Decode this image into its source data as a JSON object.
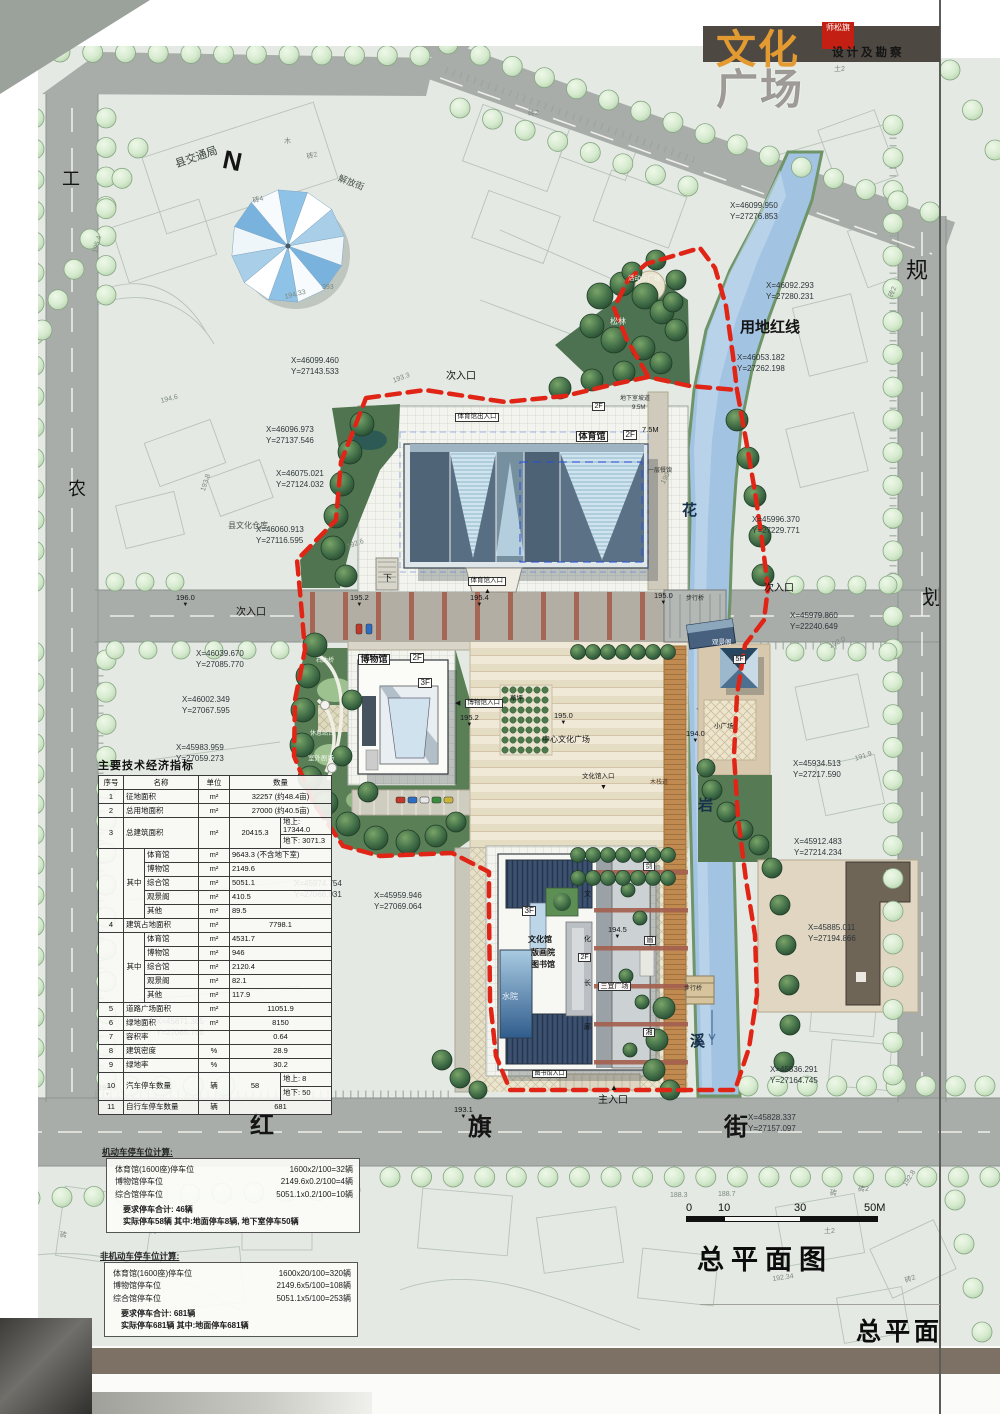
{
  "page": {
    "brand_top": "文化",
    "brand_bottom": "广场",
    "seal": "师松旗",
    "subtitle": "设计及勘察",
    "plan_title": "总平面图",
    "corner_label": "总平面"
  },
  "scalebar": {
    "labels": [
      "0",
      "10",
      "30",
      "50M"
    ]
  },
  "indicators": {
    "title": "主要技术经济指标",
    "headers": [
      "序号",
      "名称",
      "单位",
      "数量"
    ],
    "rows": [
      {
        "no": "1",
        "name": "征地面积",
        "unit": "m²",
        "qty": "32257 (约48.4亩)"
      },
      {
        "no": "2",
        "name": "总用地面积",
        "unit": "m²",
        "qty": "27000 (约40.5亩)"
      },
      {
        "no": "3",
        "name": "总建筑面积",
        "unit": "m²",
        "qty": "20415.3",
        "split": [
          "地上: 17344.0",
          "地下: 3071.3"
        ]
      },
      {
        "group": "其中",
        "items": [
          {
            "name": "体育馆",
            "unit": "m²",
            "qty": "9643.3 (不含地下室)"
          },
          {
            "name": "博物馆",
            "unit": "m²",
            "qty": "2149.6"
          },
          {
            "name": "综合馆",
            "unit": "m²",
            "qty": "5051.1"
          },
          {
            "name": "观景阁",
            "unit": "m²",
            "qty": "410.5"
          },
          {
            "name": "其他",
            "unit": "m²",
            "qty": "89.5"
          }
        ]
      },
      {
        "no": "4",
        "name": "建筑占地面积",
        "unit": "m²",
        "qty": "7798.1"
      },
      {
        "group": "其中",
        "items": [
          {
            "name": "体育馆",
            "unit": "m²",
            "qty": "4531.7"
          },
          {
            "name": "博物馆",
            "unit": "m²",
            "qty": "946"
          },
          {
            "name": "综合馆",
            "unit": "m²",
            "qty": "2120.4"
          },
          {
            "name": "观景阁",
            "unit": "m²",
            "qty": "82.1"
          },
          {
            "name": "其他",
            "unit": "m²",
            "qty": "117.9"
          }
        ]
      },
      {
        "no": "5",
        "name": "道路广场面积",
        "unit": "m²",
        "qty": "11051.9"
      },
      {
        "no": "6",
        "name": "绿地面积",
        "unit": "m²",
        "qty": "8150"
      },
      {
        "no": "7",
        "name": "容积率",
        "unit": "",
        "qty": "0.64"
      },
      {
        "no": "8",
        "name": "建筑密度",
        "unit": "%",
        "qty": "28.9"
      },
      {
        "no": "9",
        "name": "绿地率",
        "unit": "%",
        "qty": "30.2"
      },
      {
        "no": "10",
        "name": "汽车停车数量",
        "unit": "辆",
        "qty": "58",
        "split": [
          "地上:  8",
          "地下:  50"
        ]
      },
      {
        "no": "11",
        "name": "自行车停车数量",
        "unit": "辆",
        "qty": "681"
      }
    ]
  },
  "parking": {
    "motor": {
      "heading": "机动车停车位计算:",
      "rows": [
        [
          "体育馆(1600座)停车位",
          "1600x2/100=32辆"
        ],
        [
          "博物馆停车位",
          "2149.6x0.2/100=4辆"
        ],
        [
          "综合馆停车位",
          "5051.1x0.2/100=10辆"
        ]
      ],
      "required": "要求停车合计: 46辆",
      "actual": "实际停车58辆  其中:地面停车8辆, 地下室停车50辆"
    },
    "nonmotor": {
      "heading": "非机动车停车位计算:",
      "rows": [
        [
          "体育馆(1600座)停车位",
          "1600x20/100=320辆"
        ],
        [
          "博物馆停车位",
          "2149.6x5/100=108辆"
        ],
        [
          "综合馆停车位",
          "5051.1x5/100=253辆"
        ]
      ],
      "required": "要求停车合计: 681辆",
      "actual": "实际停车681辆  其中:地面停车681辆"
    }
  },
  "map": {
    "colors": {
      "boundary_red": "#e02517",
      "river_blue": "#a2c4e2",
      "road_gray": "#a8adaa",
      "roof_slate": "#506478",
      "roof_light": "#cbe0ea",
      "tree_light": "#d7ebd2",
      "tree_dark": "#30593a",
      "brand_orange": "#e29a31",
      "titlebar_dark": "#4e4843",
      "bottom_band": "#7c7164"
    },
    "labels": [
      {
        "t": "工",
        "x": 62,
        "y": 170,
        "s": 18
      },
      {
        "t": "农",
        "x": 68,
        "y": 480,
        "s": 18
      },
      {
        "t": "规",
        "x": 906,
        "y": 260,
        "s": 22
      },
      {
        "t": "划",
        "x": 922,
        "y": 588,
        "s": 20
      },
      {
        "t": "N",
        "x": 226,
        "y": 146,
        "s": 26,
        "w": 700,
        "r": 12
      },
      {
        "t": "县交通局",
        "x": 174,
        "y": 160,
        "s": 11,
        "r": -19,
        "c": "#39433d"
      },
      {
        "t": "解放街",
        "x": 340,
        "y": 174,
        "s": 9,
        "r": 21,
        "c": "#4a544e"
      },
      {
        "t": "县文化仓库",
        "x": 228,
        "y": 522,
        "s": 8,
        "c": "#4a544e"
      },
      {
        "t": "用地红线",
        "x": 740,
        "y": 320,
        "s": 15,
        "w": 700
      },
      {
        "t": "次入口",
        "x": 446,
        "y": 372,
        "s": 10
      },
      {
        "t": "次入口",
        "x": 236,
        "y": 608,
        "s": 10
      },
      {
        "t": "次入口",
        "x": 764,
        "y": 584,
        "s": 10
      },
      {
        "t": "主入口",
        "x": 598,
        "y": 1096,
        "s": 10
      },
      {
        "t": "红",
        "x": 250,
        "y": 1114,
        "s": 24,
        "w": 700
      },
      {
        "t": "旗",
        "x": 468,
        "y": 1116,
        "s": 24,
        "w": 700
      },
      {
        "t": "街",
        "x": 724,
        "y": 1116,
        "s": 24,
        "w": 700
      },
      {
        "t": "花",
        "x": 682,
        "y": 503,
        "s": 15,
        "w": 700,
        "c": "#17304c"
      },
      {
        "t": "岩",
        "x": 698,
        "y": 798,
        "s": 15,
        "w": 700,
        "c": "#17304c"
      },
      {
        "t": "溪",
        "x": 690,
        "y": 1034,
        "s": 15,
        "w": 700,
        "c": "#17304c"
      },
      {
        "t": "体育馆",
        "x": 576,
        "y": 431,
        "s": 9,
        "w": 700,
        "bg": 1
      },
      {
        "t": "2F",
        "x": 623,
        "y": 430,
        "s": 8,
        "bg": 1
      },
      {
        "t": "体育馆出入口",
        "x": 455,
        "y": 413,
        "s": 6.5,
        "bg": 1
      },
      {
        "t": "体育馆入口",
        "x": 468,
        "y": 577,
        "s": 6.5,
        "bg": 1
      },
      {
        "t": "下",
        "x": 383,
        "y": 574,
        "s": 9
      },
      {
        "t": "7.5M",
        "x": 642,
        "y": 426,
        "s": 7.5
      },
      {
        "t": "一层餐饮",
        "x": 648,
        "y": 468,
        "s": 6,
        "c": "#333333"
      },
      {
        "t": "地下室坡道",
        "x": 620,
        "y": 396,
        "s": 6,
        "c": "#333333"
      },
      {
        "t": "9.5M",
        "x": 632,
        "y": 405,
        "s": 6,
        "c": "#333333"
      },
      {
        "t": "2F",
        "x": 592,
        "y": 402,
        "s": 7,
        "bg": 1
      },
      {
        "t": "活动小广场",
        "x": 628,
        "y": 276,
        "s": 6.5,
        "c": "#f2f6f0"
      },
      {
        "t": "松林",
        "x": 610,
        "y": 318,
        "s": 8,
        "c": "#e9f1e5"
      },
      {
        "t": "博物馆",
        "x": 358,
        "y": 654,
        "s": 9,
        "w": 700,
        "bg": 1
      },
      {
        "t": "2F",
        "x": 410,
        "y": 653,
        "s": 8,
        "bg": 1
      },
      {
        "t": "3F",
        "x": 418,
        "y": 678,
        "s": 8,
        "bg": 1
      },
      {
        "t": "◀",
        "x": 455,
        "y": 700,
        "s": 7
      },
      {
        "t": "博物馆入口",
        "x": 465,
        "y": 699,
        "s": 6.5,
        "bg": 1
      },
      {
        "t": "草坪",
        "x": 510,
        "y": 696,
        "s": 6.5
      },
      {
        "t": "中心文化广场",
        "x": 542,
        "y": 736,
        "s": 8
      },
      {
        "t": "文化馆入口",
        "x": 582,
        "y": 774,
        "s": 6.5
      },
      {
        "t": "▼",
        "x": 600,
        "y": 784,
        "s": 7
      },
      {
        "t": "石曲桥",
        "x": 316,
        "y": 658,
        "s": 6,
        "c": "#eef4ea"
      },
      {
        "t": "休息站台",
        "x": 310,
        "y": 731,
        "s": 6,
        "c": "#eef4ea"
      },
      {
        "t": "室外剧场",
        "x": 308,
        "y": 756,
        "s": 6.5,
        "c": "#eef4ea"
      },
      {
        "t": "观景阁",
        "x": 712,
        "y": 640,
        "s": 6.5,
        "c": "#f0f4f6"
      },
      {
        "t": "5F",
        "x": 733,
        "y": 655,
        "s": 7,
        "bg": 1
      },
      {
        "t": "小广场",
        "x": 714,
        "y": 724,
        "s": 6.5
      },
      {
        "t": "步行桥",
        "x": 686,
        "y": 596,
        "s": 6,
        "c": "#2b2b2b"
      },
      {
        "t": "步行桥",
        "x": 684,
        "y": 986,
        "s": 6,
        "c": "#2b2b2b"
      },
      {
        "t": "木栈道",
        "x": 650,
        "y": 780,
        "s": 6,
        "c": "#5a3c20"
      },
      {
        "t": "文化馆",
        "x": 528,
        "y": 936,
        "s": 8,
        "w": 700
      },
      {
        "t": "版画院",
        "x": 531,
        "y": 949,
        "s": 8,
        "w": 700
      },
      {
        "t": "图书馆",
        "x": 531,
        "y": 961,
        "s": 8,
        "w": 700
      },
      {
        "t": "3F",
        "x": 522,
        "y": 906,
        "s": 8,
        "bg": 1
      },
      {
        "t": "2F",
        "x": 578,
        "y": 953,
        "s": 7,
        "bg": 1
      },
      {
        "t": "水院",
        "x": 502,
        "y": 993,
        "s": 8,
        "c": "#eaf2f8"
      },
      {
        "t": "三宜广场",
        "x": 598,
        "y": 982,
        "s": 7,
        "bg": 1
      },
      {
        "t": "图书馆入口",
        "x": 532,
        "y": 1070,
        "s": 6,
        "bg": 1
      },
      {
        "t": "▲",
        "x": 610,
        "y": 1084,
        "s": 8
      },
      {
        "t": "▲",
        "x": 484,
        "y": 588,
        "s": 7
      },
      {
        "t": "文",
        "x": 584,
        "y": 891,
        "s": 7
      },
      {
        "t": "化",
        "x": 584,
        "y": 936,
        "s": 7
      },
      {
        "t": "长",
        "x": 584,
        "y": 980,
        "s": 7
      },
      {
        "t": "廊",
        "x": 584,
        "y": 1024,
        "s": 7
      },
      {
        "t": "剑",
        "x": 643,
        "y": 862,
        "s": 7,
        "bg": 1
      },
      {
        "t": "眉",
        "x": 644,
        "y": 936,
        "s": 7,
        "bg": 1
      },
      {
        "t": "湘",
        "x": 643,
        "y": 1028,
        "s": 7,
        "bg": 1
      },
      {
        "t": "195.4",
        "x": 92,
        "y": 252,
        "s": 7,
        "r": -75,
        "c": "#7c887e"
      },
      {
        "t": "194.6",
        "x": 160,
        "y": 398,
        "s": 7,
        "r": -14,
        "c": "#7c887e"
      },
      {
        "t": "193.8",
        "x": 200,
        "y": 490,
        "s": 7,
        "r": -72,
        "c": "#7c887e"
      },
      {
        "t": "194.33",
        "x": 284,
        "y": 294,
        "s": 7,
        "r": -14,
        "c": "#7c887e"
      },
      {
        "t": "393",
        "x": 322,
        "y": 284,
        "s": 7,
        "c": "#7c887e"
      },
      {
        "t": "193.3",
        "x": 392,
        "y": 378,
        "s": 7,
        "r": -20,
        "c": "#7c887e"
      },
      {
        "t": "192.6",
        "x": 346,
        "y": 544,
        "s": 7,
        "r": -20,
        "c": "#7c887e"
      },
      {
        "t": "190.8",
        "x": 660,
        "y": 482,
        "s": 7,
        "r": -62,
        "c": "#7c887e"
      },
      {
        "t": "192.0",
        "x": 828,
        "y": 644,
        "s": 7,
        "r": -28,
        "c": "#7c887e"
      },
      {
        "t": "191.9",
        "x": 854,
        "y": 756,
        "s": 7,
        "r": -18,
        "c": "#7c887e"
      },
      {
        "t": "188.3",
        "x": 670,
        "y": 1192,
        "s": 7,
        "c": "#7c887e"
      },
      {
        "t": "188.7",
        "x": 718,
        "y": 1191,
        "s": 7,
        "c": "#7c887e"
      },
      {
        "t": "192.34",
        "x": 772,
        "y": 1276,
        "s": 7,
        "r": -8,
        "c": "#7c887e"
      },
      {
        "t": "192.8",
        "x": 902,
        "y": 1184,
        "s": 7,
        "r": -58,
        "c": "#7c887e"
      },
      {
        "t": "砖4",
        "x": 252,
        "y": 198,
        "s": 7,
        "r": -14,
        "c": "#7c887e"
      },
      {
        "t": "砖2",
        "x": 306,
        "y": 154,
        "s": 7,
        "r": -14,
        "c": "#7c887e"
      },
      {
        "t": "木",
        "x": 284,
        "y": 138,
        "s": 7,
        "c": "#7c887e"
      },
      {
        "t": "砖2",
        "x": 528,
        "y": 110,
        "s": 7,
        "c": "#7c887e"
      },
      {
        "t": "土2",
        "x": 834,
        "y": 66,
        "s": 7,
        "c": "#7c887e"
      },
      {
        "t": "砖2",
        "x": 888,
        "y": 296,
        "s": 7,
        "r": -70,
        "c": "#7c887e"
      },
      {
        "t": "砖",
        "x": 830,
        "y": 1190,
        "s": 7,
        "c": "#7c887e"
      },
      {
        "t": "土2",
        "x": 824,
        "y": 1228,
        "s": 7,
        "c": "#7c887e"
      },
      {
        "t": "砖2",
        "x": 858,
        "y": 1186,
        "s": 7,
        "c": "#7c887e"
      },
      {
        "t": "砖2",
        "x": 904,
        "y": 1278,
        "s": 7,
        "r": -20,
        "c": "#7c887e"
      },
      {
        "t": "砖2",
        "x": 150,
        "y": 1228,
        "s": 7,
        "c": "#7c887e"
      },
      {
        "t": "砖",
        "x": 60,
        "y": 1232,
        "s": 7,
        "c": "#7c887e"
      }
    ],
    "coordinates": [
      {
        "x": 730,
        "y": 200,
        "X": "X=46099.950",
        "Y": "Y=27276.853"
      },
      {
        "x": 766,
        "y": 280,
        "X": "X=46092.293",
        "Y": "Y=27280.231"
      },
      {
        "x": 737,
        "y": 352,
        "X": "X=46053.182",
        "Y": "Y=27262.198"
      },
      {
        "x": 291,
        "y": 355,
        "X": "X=46099.460",
        "Y": "Y=27143.533"
      },
      {
        "x": 266,
        "y": 424,
        "X": "X=46096.973",
        "Y": "Y=27137.546"
      },
      {
        "x": 276,
        "y": 468,
        "X": "X=46075.021",
        "Y": "Y=27124.032"
      },
      {
        "x": 256,
        "y": 524,
        "X": "X=46060.913",
        "Y": "Y=27116.595"
      },
      {
        "x": 196,
        "y": 648,
        "X": "X=46039.670",
        "Y": "Y=27085.770"
      },
      {
        "x": 182,
        "y": 694,
        "X": "X=46002.349",
        "Y": "Y=27067.595"
      },
      {
        "x": 176,
        "y": 742,
        "X": "X=45983.959",
        "Y": "Y=27059.273"
      },
      {
        "x": 790,
        "y": 610,
        "X": "X=45979.860",
        "Y": "Y=22240.649"
      },
      {
        "x": 752,
        "y": 514,
        "X": "X=45996.370",
        "Y": "Y=27229.771"
      },
      {
        "x": 793,
        "y": 758,
        "X": "X=45934.513",
        "Y": "Y=27217.590"
      },
      {
        "x": 294,
        "y": 878,
        "X": "X=45974.754",
        "Y": "Y=27068.931"
      },
      {
        "x": 374,
        "y": 890,
        "X": "X=45959.946",
        "Y": "Y=27069.064"
      },
      {
        "x": 794,
        "y": 836,
        "X": "X=45912.483",
        "Y": "Y=27214.234"
      },
      {
        "x": 808,
        "y": 922,
        "X": "X=45885.011",
        "Y": "Y=27194.866"
      },
      {
        "x": 156,
        "y": 1016,
        "X": "X=45871.385",
        "Y": "Y=27085.756"
      },
      {
        "x": 770,
        "y": 1064,
        "X": "X=45836.291",
        "Y": "Y=27164.745"
      },
      {
        "x": 748,
        "y": 1112,
        "X": "X=45828.337",
        "Y": "Y=27157.097"
      }
    ],
    "elevations": [
      {
        "v": "196.0",
        "x": 176,
        "y": 594
      },
      {
        "v": "195.2",
        "x": 350,
        "y": 594
      },
      {
        "v": "195.4",
        "x": 470,
        "y": 594
      },
      {
        "v": "195.0",
        "x": 654,
        "y": 592
      },
      {
        "v": "195.2",
        "x": 460,
        "y": 714
      },
      {
        "v": "195.0",
        "x": 554,
        "y": 712
      },
      {
        "v": "194.0",
        "x": 686,
        "y": 730
      },
      {
        "v": "194.5",
        "x": 608,
        "y": 926
      },
      {
        "v": "193.1",
        "x": 454,
        "y": 1106
      },
      {
        "v": "193.0",
        "x": 98,
        "y": 1084
      }
    ]
  }
}
